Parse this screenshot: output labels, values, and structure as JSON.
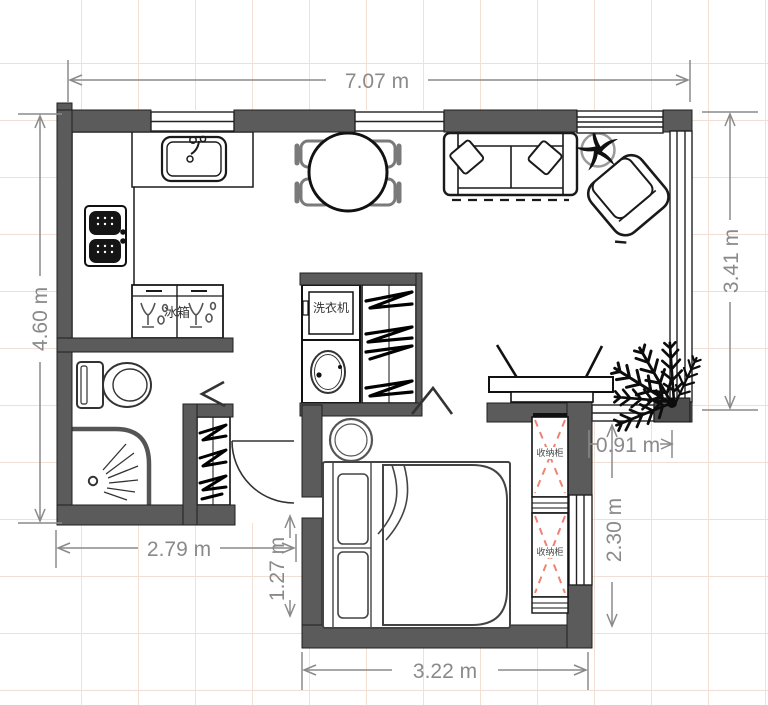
{
  "dims": {
    "total_width": "7.07 m",
    "left_height": "4.60 m",
    "right_height": "3.41 m",
    "bath_width": "2.79 m",
    "entry_segment": "1.27 m",
    "passage_width": "0.91 m",
    "bedroom_side": "2.30 m",
    "bedroom_width": "3.22 m"
  },
  "labels": {
    "washer": "洗衣机",
    "fridge": "冰箱",
    "storage_top": "收纳柜",
    "storage_bottom": "收纳柜"
  },
  "colors": {
    "wall": "#5b5b5b",
    "dimension": "#8a8a8a",
    "cabinet_cross_dash": "#ef8373",
    "grid_line": "#f3e0d2",
    "chair": "#7a7a7a"
  }
}
